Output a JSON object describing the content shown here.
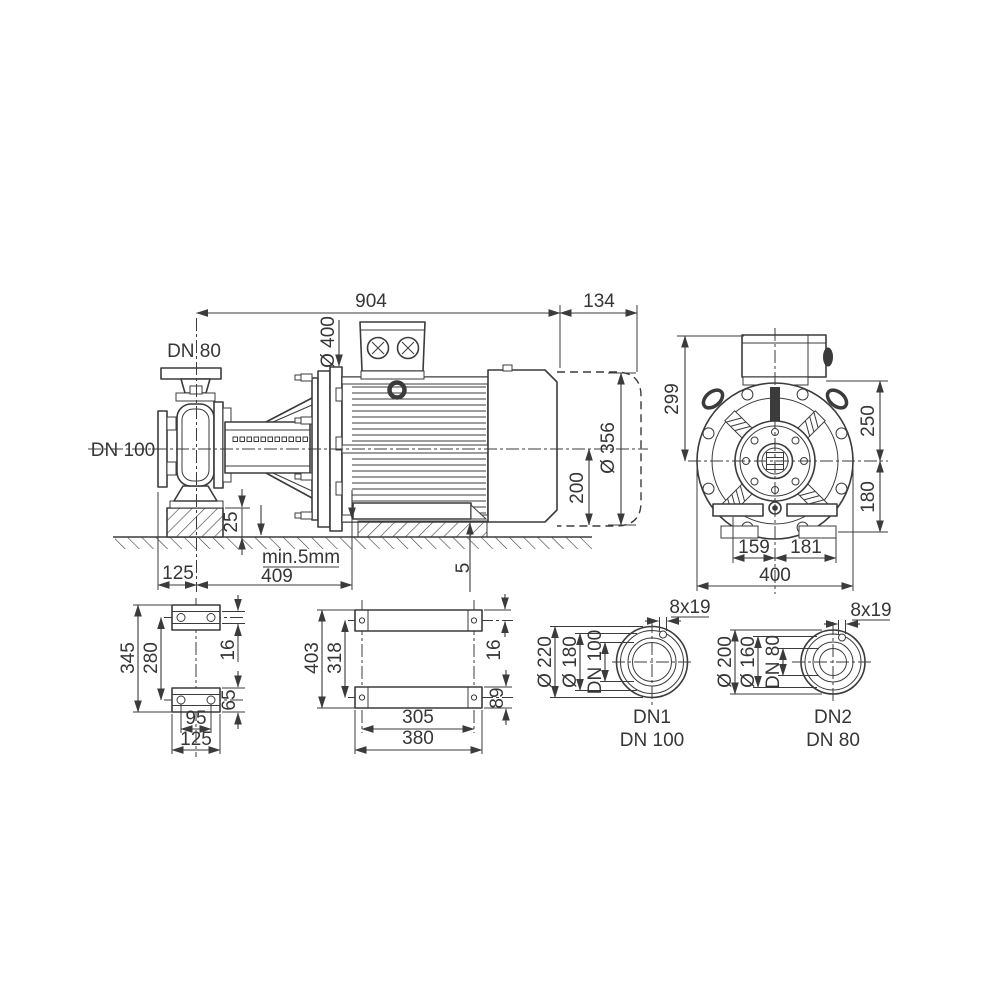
{
  "side": {
    "d904": "904",
    "d134": "134",
    "dn80": "DN 80",
    "dn100": "DN 100",
    "d400": "Ø 400",
    "d356": "Ø 356",
    "d200": "200",
    "d25": "25",
    "min5": "min.5mm",
    "d125": "125",
    "d409": "409",
    "d5": "5"
  },
  "end": {
    "d299": "299",
    "d250": "250",
    "d180": "180",
    "d159": "159",
    "d181": "181",
    "d400": "400"
  },
  "pumpfoot": {
    "d345": "345",
    "d280": "280",
    "d16": "16",
    "d65": "65",
    "d95": "95",
    "d125": "125"
  },
  "motorfoot": {
    "d403": "403",
    "d318": "318",
    "d16": "16",
    "d89": "89",
    "d305": "305",
    "d380": "380"
  },
  "flange1": {
    "outer": "Ø 220",
    "boltcircle": "Ø 180",
    "bore": "DN 100",
    "holes": "8x19",
    "port": "DN1",
    "size": "DN 100"
  },
  "flange2": {
    "outer": "Ø 200",
    "boltcircle": "Ø 160",
    "bore": "DN 80",
    "holes": "8x19",
    "port": "DN2",
    "size": "DN 80"
  },
  "colors": {
    "line": "#3b3b3b",
    "background": "#ffffff"
  }
}
